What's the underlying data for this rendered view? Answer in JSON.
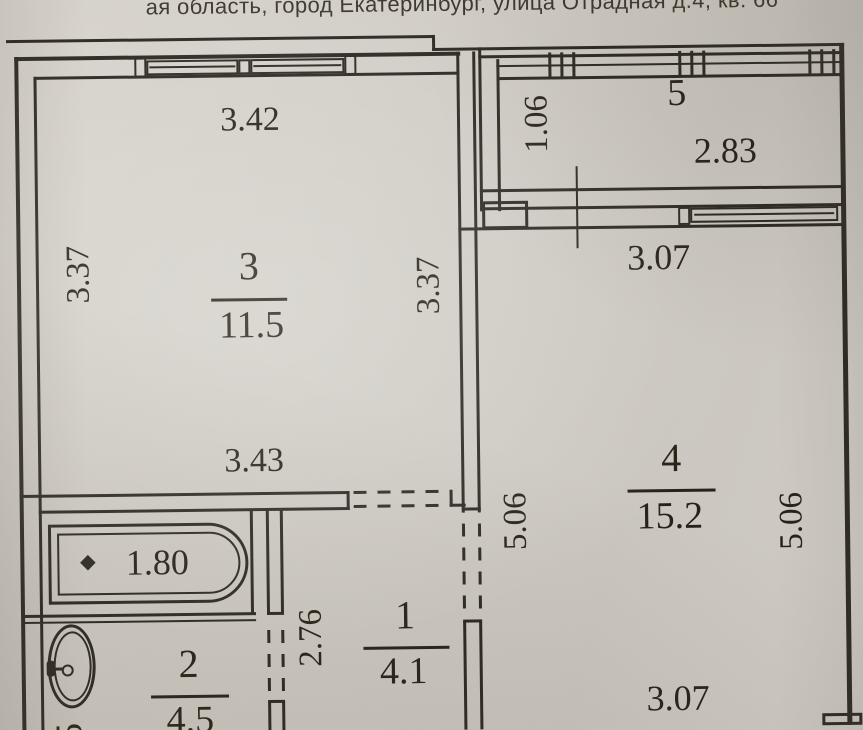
{
  "document": {
    "address_line": "ая область, город Екатеринбург, улица Отрадная д.4, кв. 66"
  },
  "plan": {
    "room3": {
      "number": "3",
      "area": "11.5",
      "dim_top": "3.42",
      "dim_left": "3.37",
      "dim_right": "3.37",
      "dim_bottom": "3.43"
    },
    "room5": {
      "number": "5",
      "dim_depth": "1.06",
      "dim_width": "2.83"
    },
    "room4": {
      "number": "4",
      "area": "15.2",
      "dim_top": "3.07",
      "dim_left": "5.06",
      "dim_right": "5.06",
      "dim_bottom": "3.07"
    },
    "room1": {
      "number": "1",
      "area": "4.1",
      "dim_left": "2.76"
    },
    "room2": {
      "number": "2",
      "area": "4.5"
    },
    "bath": {
      "tub_length": "1.80"
    },
    "edge_partial_dim": "5"
  },
  "colors": {
    "ink": "#2b2822",
    "paper": "#d2cec7"
  }
}
